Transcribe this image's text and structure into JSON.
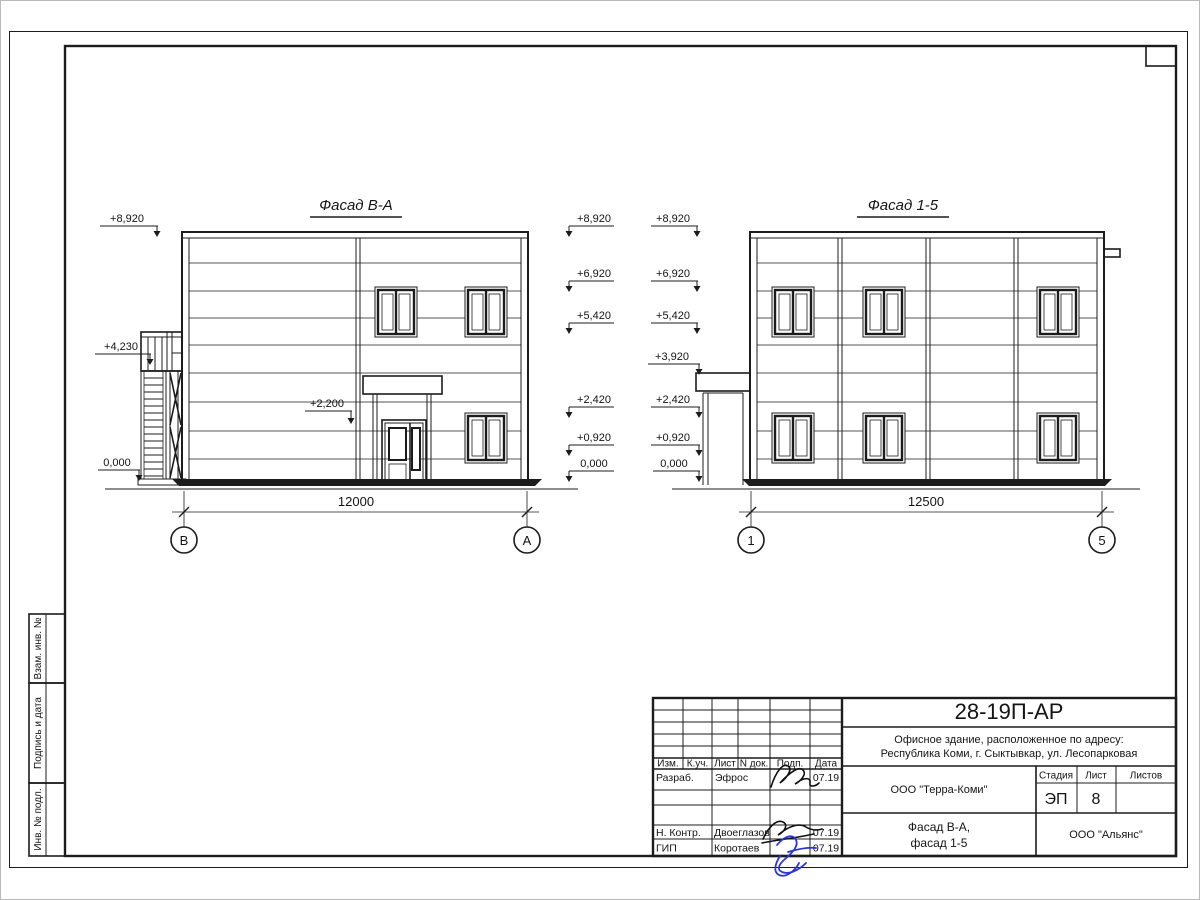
{
  "sheet": {
    "side_stamps": [
      {
        "label": "Взам. инв. №"
      },
      {
        "label": "Подпись и дата"
      },
      {
        "label": "Инв. № подл."
      }
    ]
  },
  "facade_left": {
    "title": "Фасад В-А",
    "elev_8920": "+8,920",
    "elev_4230": "+4,230",
    "elev_0": "0,000",
    "elev_2200": "+2,200",
    "right_col": {
      "e1": "+8,920",
      "e2": "+6,920",
      "e3": "+5,420",
      "e4": "+2,420",
      "e5": "+0,920",
      "e6": "0,000"
    },
    "dimension": "12000",
    "axis_left": "В",
    "axis_right": "А"
  },
  "facade_right": {
    "title": "Фасад 1-5",
    "left_col": {
      "e1": "+8,920",
      "e2": "+6,920",
      "e3": "+5,420",
      "e4": "+3,920",
      "e5": "+2,420",
      "e6": "+0,920",
      "e7": "0,000"
    },
    "dimension": "12500",
    "axis_left": "1",
    "axis_right": "5"
  },
  "title_block": {
    "doc_number": "28-19П-АР",
    "description_line1": "Офисное здание, расположенное по адресу:",
    "description_line2": "Республика Коми, г. Сыктывкар, ул. Лесопарковая",
    "header": {
      "izm": "Изм.",
      "kuch": "К.уч.",
      "list": "Лист",
      "ndok": "N док.",
      "podp": "Подп.",
      "data": "Дата"
    },
    "rows": [
      {
        "role": "Разраб.",
        "name": "Эфрос",
        "date": "07.19"
      },
      {
        "role": "Н. Контр.",
        "name": "Двоеглазов",
        "date": "07.19"
      },
      {
        "role": "ГИП",
        "name": "Коротаев",
        "date": "07.19"
      }
    ],
    "organization": "ООО \"Терра-Коми\"",
    "stage_label": "Стадия",
    "stage_value": "ЭП",
    "sheet_label": "Лист",
    "sheet_value": "8",
    "sheets_label": "Листов",
    "drawing_title_line1": "Фасад В-А,",
    "drawing_title_line2": "фасад 1-5",
    "contractor": "ООО \"Альянс\""
  }
}
